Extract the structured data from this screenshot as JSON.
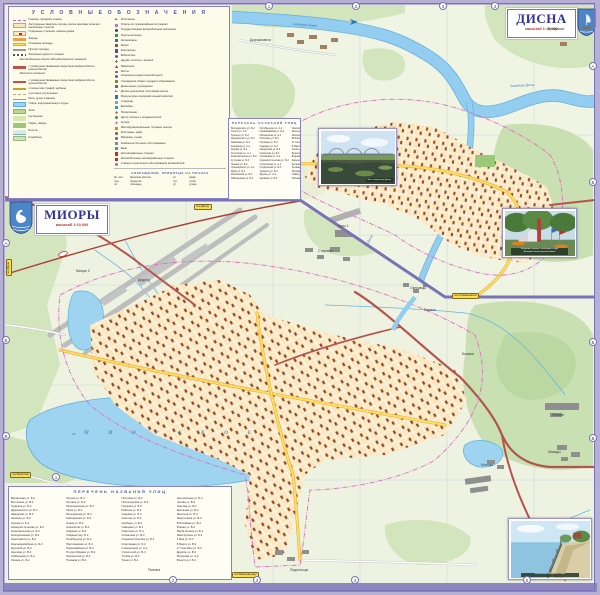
{
  "legend": {
    "title": "У С Л О В Н Ы Е   О Б О З Н А Ч Е Н И Я",
    "left_items": [
      {
        "sw": "pink-dash",
        "t": "Границы городских земель"
      },
      {
        "sw": "tan-block",
        "t": "Застроенные кварталы города, жилые массивы сельских населённых пунктов"
      },
      {
        "sw": "tan-dot",
        "t": "Отдельные строения, номера домов"
      },
      {
        "sw": "orange-line",
        "t": "Заезды"
      },
      {
        "sw": "yellow-line",
        "t": "Основные проезды"
      },
      {
        "sw": "white-line",
        "t": "Прочие проезды"
      },
      {
        "sw": "rail-line",
        "t": "Железные дороги и станции"
      },
      {
        "sw": "header",
        "t": "Автомобильные дороги Республиканского значения:"
      },
      {
        "sw": "red-line",
        "t": "с усовершенствованным покрытием (асфальтобетон, цементобетон)"
      },
      {
        "sw": "header",
        "t": "Местного значения:"
      },
      {
        "sw": "red-thin",
        "t": "с усовершенствованным покрытием (асфальтобетон, цементобетон)"
      },
      {
        "sw": "gravel-line",
        "t": "с покрытием (гравий, щебень)"
      },
      {
        "sw": "dirt-line",
        "t": "грунтовые улучшенные"
      },
      {
        "sw": "blue-line",
        "t": "Реки, ручьи и каналы"
      },
      {
        "sw": "blue-rect",
        "t": "Озёра, водохранилища и пруды"
      },
      {
        "sw": "green-rect",
        "t": "Леса"
      },
      {
        "sw": "lightgreen-rect",
        "t": "Кустарники"
      },
      {
        "sw": "park-rect",
        "t": "Парки, скверы"
      },
      {
        "sw": "swamp-rect",
        "t": "Болота"
      },
      {
        "sw": "cemetery-rect",
        "t": "Кладбища"
      }
    ],
    "right_items": [
      {
        "ic": "flag-red",
        "t": "Исполкомы"
      },
      {
        "ic": "ring-magenta",
        "t": "Отделы по чрезвычайным ситуациям"
      },
      {
        "ic": "dot-dark",
        "t": "Государственная автомобильная инспекция"
      },
      {
        "ic": "sq-green",
        "t": "Пункты милиции"
      },
      {
        "ic": "sq-blue",
        "t": "Автовокзалы"
      },
      {
        "ic": "sq-brown",
        "t": "Музеи"
      },
      {
        "ic": "sq-purple",
        "t": "Кинотеатры"
      },
      {
        "ic": "dot-blue",
        "t": "Библиотеки"
      },
      {
        "ic": "cross-dark",
        "t": "Церкви, костёлы, часовни"
      },
      {
        "ic": "tri-red",
        "t": "Памятники"
      },
      {
        "ic": "bar-gray",
        "t": "Мосты"
      },
      {
        "ic": "dot-blue",
        "t": "Социально-педагогический центр"
      },
      {
        "ic": "sq-olive",
        "t": "Учреждения общего среднего образования"
      },
      {
        "ic": "sq-teal",
        "t": "Дошкольные учреждения"
      },
      {
        "ic": "flag-blue",
        "t": "Детско-юношеская спортивная школа"
      },
      {
        "ic": "sq-blue",
        "t": "Физкультурно-оздоровительный комплекс"
      },
      {
        "ic": "ring-gray",
        "t": "Стадионы"
      },
      {
        "ic": "sq-cyan",
        "t": "Бассейны"
      },
      {
        "ic": "cross-red",
        "t": "Поликлиники"
      },
      {
        "ic": "dot-green",
        "t": "Центр гигиены и эпидемиологии"
      },
      {
        "ic": "cross-magenta",
        "t": "Аптеки"
      },
      {
        "ic": "sq-orange",
        "t": "Многофункциональные торговые центры"
      },
      {
        "ic": "dot-brown",
        "t": "Рестораны, кафе"
      },
      {
        "ic": "dot-blue",
        "t": "Магазины, рынки"
      },
      {
        "ic": "sq-gray",
        "t": "Комбинаты бытового обслуживания"
      },
      {
        "ic": "sq-cyan",
        "t": "Бани"
      },
      {
        "ic": "sq-red",
        "t": "Автозаправочные станции"
      },
      {
        "ic": "sq-red",
        "t": "Автомобильные газозаправочные станции"
      },
      {
        "ic": "dot-gray",
        "t": "Станции технического обслуживания автомобилей"
      }
    ],
    "abbreviations": {
      "title": "СОКРАЩЕНИЯ, ПРИНЯТЫЕ НА ПЛАНАХ",
      "col_a": [
        {
          "a": "бр. мог.",
          "m": "братская могила"
        },
        {
          "a": "пер.",
          "m": "переулок"
        },
        {
          "a": "пл.",
          "m": "площадь"
        }
      ],
      "col_b": [
        {
          "a": "ск.",
          "m": "сквер"
        },
        {
          "a": "туп.",
          "m": "тупик"
        },
        {
          "a": "ул.",
          "m": "улица"
        }
      ]
    }
  },
  "disna": {
    "name": "ДИСНА",
    "scale": "масштаб 1:10 000",
    "street_list": {
      "title": "ПЕРЕЧЕНЬ НАЗВАНИЙ УЛИЦ",
      "col1": [
        "Володарского ул. Б-2",
        "Гоголя ул. А-2",
        "Горького ул. Б-2",
        "Дзержинского ул. Б-1",
        "Замковая ул. Б-2",
        "Калинина ул. А-2",
        "Кирова ул. Б-2",
        "Колхозная ул. А-1",
        "Комсомольская ул. Б-2",
        "Кутузова ул. Б-3",
        "Ленина ул. Б-2",
        "Луначарского ул. А-2",
        "Мира ул. Б-2",
        "Московская ул. Б-3",
        "Набережная ул. Б-2"
      ],
      "col2": [
        "Октябрьская ул. А-2",
        "Первомайская ул. Б-2",
        "Пионерская ул. А-1",
        "Полоцкая ул. Б-3",
        "Пушкина ул. Б-2",
        "Садовая ул. А-2",
        "Свердлова ул. Б-2",
        "Советская ул. Б-2",
        "Соловьёва ул. А-2",
        "Социалистическая ул. Б-2",
        "Спортивная ул. А-1",
        "Стадионная ул. Б-3",
        "Урицкого ул. Б-2",
        "Фрунзе ул. А-2",
        "Чапаева ул. Б-2"
      ],
      "col3": [
        "Чкалова ул. Б-3",
        "Школьная ул. А-2",
        "Энгельса ул. Б-2",
        "Юбилейная ул. А-2",
        "17 Сентября ул. Б-2",
        "8 Марта ул. А-1",
        "Азина ул. Б-2",
        "Береговая ул. Б-2",
        "Водная ул. Б-3",
        "Заречная ул. А-2",
        "Зелёная ул. А-1",
        "Лесная ул. А-2",
        "Молодёжная ул. Б-3",
        "Новая ул. Б-3",
        "Полевая ул. А-1"
      ]
    },
    "photo_caption": "Мост через реку Дисну"
  },
  "miory": {
    "name": "МИОРЫ",
    "scale": "масштаб 1:10 000",
    "street_list": {
      "title": "ПЕРЕЧЕНЬ НАЗВАНИЙ УЛИЦ",
      "col1": [
        "Вокзальная ул. Б-2",
        "Восточная ул. В-4",
        "Гагарина ул. Б-3",
        "Дзержинского ул. Б-2",
        "Заводская ул. В-3",
        "Зелёная ул. Б-3",
        "Кирова ул. Б-2",
        "Коммунистическая ул. Б-2",
        "Комсомольская ул. Б-3",
        "Кооперативная ул. В-3",
        "Короткевича ул. Б-2",
        "Красноармейская ул. Б-3",
        "Крупской ул. В-2",
        "Крылова ул. В-3",
        "Куйбышева ул. Б-2",
        "Ленина ул. Б-2"
      ],
      "col2": [
        "Лесная ул. В-4",
        "Луговая ул. Б-3",
        "Мелиораторов ул. В-3",
        "Мира ул. Б-2",
        "Молодёжная ул. В-3",
        "Набережная ул. Б-3",
        "Новая ул. В-4",
        "Новосёлов ул. В-4",
        "Озёрная ул. Б-3",
        "Озёрный пер. Б-3",
        "Октябрьская ул. Б-2",
        "Партизанская ул. Б-3",
        "Первомайская ул. Б-2",
        "Петруся Бровки ул. В-3",
        "Пионерская ул. Б-2",
        "Полевая ул. В-4"
      ],
      "col3": [
        "Почтовая ул. Б-2",
        "Пролетарская ул. Б-3",
        "Пушкина ул. Б-2",
        "Рабочая ул. В-3",
        "Садовая ул. Б-3",
        "Светлая ул. В-4",
        "Свободы ул. Б-2",
        "Северная ул. Б-3",
        "Советская ул. Б-2",
        "Солнечная ул. В-3",
        "Социалистическая ул. Б-3",
        "Спортивная ул. Б-2",
        "Станционная ул. А-2",
        "Строителей ул. В-3",
        "Титова ул. В-3",
        "Тихая ул. В-4"
      ],
      "col4": [
        "Центральная ул. Б-2",
        "Чехова ул. В-3",
        "Чкалова ул. Б-3",
        "Школьная ул. Б-2",
        "Энгельса ул. В-3",
        "Энергетиков ул. В-3",
        "Юбилейная ул. В-4",
        "Южная ул. В-4",
        "Якуба Коласа ул. Б-3",
        "Янки Купалы ул. Б-2",
        "1 Мая ул. Б-3",
        "8 Марта ул. В-3",
        "17 Сентября ул. Б-2",
        "Дружбы ул. В-3",
        "Молокова ул. А-2",
        "Юности ул. В-4"
      ]
    },
    "memorial_caption_l1": "Мемориал воинам, погибшим в годы",
    "memorial_caption_l2": "Великой Отечественной войны",
    "quay_caption": "Набережная Миорского озера"
  },
  "map_labels": {
    "villages": [
      {
        "t": "Дорожковичи",
        "x": 250,
        "y": 38
      },
      {
        "t": "Кучаровка",
        "x": 548,
        "y": 27
      },
      {
        "t": "Горы 1",
        "x": 338,
        "y": 224
      },
      {
        "t": "Миоры 2",
        "x": 76,
        "y": 269
      },
      {
        "t": "Дедино",
        "x": 138,
        "y": 278
      },
      {
        "t": "Стаулёво",
        "x": 318,
        "y": 249
      },
      {
        "t": "Озеравцы",
        "x": 410,
        "y": 286
      },
      {
        "t": "Блажки",
        "x": 424,
        "y": 308
      },
      {
        "t": "Блажки",
        "x": 462,
        "y": 352
      },
      {
        "t": "Плецни",
        "x": 552,
        "y": 413
      },
      {
        "t": "Мазяды",
        "x": 548,
        "y": 450
      },
      {
        "t": "Мотюки",
        "x": 481,
        "y": 463
      },
      {
        "t": "Пмелка",
        "x": 148,
        "y": 568
      },
      {
        "t": "Подъельцы",
        "x": 290,
        "y": 568
      }
    ],
    "water": [
      {
        "t": "Западная Двина",
        "x": 293,
        "y": 22,
        "rot": 4
      },
      {
        "t": "Западная Двина",
        "x": 510,
        "y": 84,
        "rot": -3
      },
      {
        "t": "Дисна",
        "x": 366,
        "y": 242,
        "rot": -62
      }
    ],
    "lake_name": "М И О Р С К О Е",
    "lake_prefix": "оз.",
    "road_signs": [
      {
        "t": "на Друю",
        "x": 6,
        "y": 276,
        "rot": -90
      },
      {
        "t": "на Браслав",
        "x": 10,
        "y": 472
      },
      {
        "t": "на Дисну",
        "x": 194,
        "y": 204
      },
      {
        "t": "на Германовичи",
        "x": 452,
        "y": 293
      },
      {
        "t": "на Шарковщину",
        "x": 232,
        "y": 572
      }
    ],
    "grid_marks": [
      {
        "t": "1",
        "x": 265,
        "y": 2
      },
      {
        "t": "2",
        "x": 352,
        "y": 2
      },
      {
        "t": "3",
        "x": 439,
        "y": 2
      },
      {
        "t": "4",
        "x": 491,
        "y": 2
      },
      {
        "t": "А",
        "x": 589,
        "y": 62
      },
      {
        "t": "Б",
        "x": 589,
        "y": 178
      },
      {
        "t": "Б",
        "x": 589,
        "y": 338
      },
      {
        "t": "В",
        "x": 589,
        "y": 434
      },
      {
        "t": "А",
        "x": 2,
        "y": 239
      },
      {
        "t": "Б",
        "x": 2,
        "y": 336
      },
      {
        "t": "В",
        "x": 2,
        "y": 432
      },
      {
        "t": "1",
        "x": 52,
        "y": 473
      },
      {
        "t": "2",
        "x": 169,
        "y": 576
      },
      {
        "t": "3",
        "x": 253,
        "y": 576
      },
      {
        "t": "4",
        "x": 351,
        "y": 576
      },
      {
        "t": "5",
        "x": 523,
        "y": 576
      }
    ]
  }
}
